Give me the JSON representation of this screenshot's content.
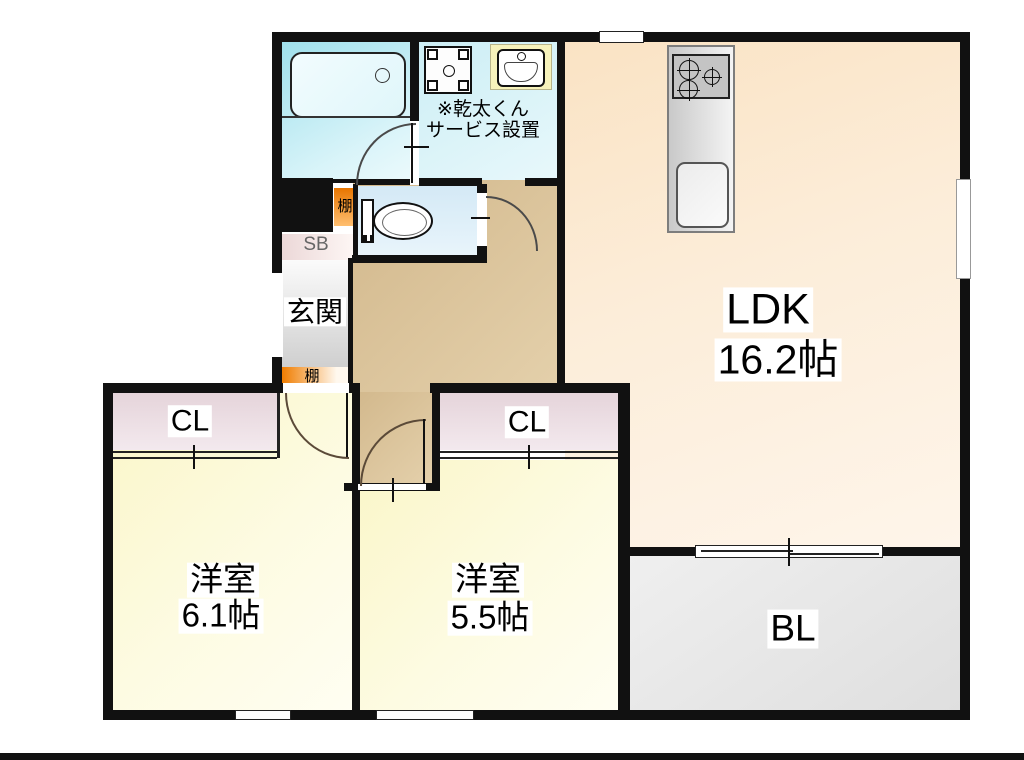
{
  "floorplan": {
    "title": "2LDK apartment floor plan",
    "ldk": {
      "name": "LDK",
      "area": "16.2帖"
    },
    "bedroom1": {
      "name": "洋室",
      "area": "6.1帖"
    },
    "bedroom2": {
      "name": "洋室",
      "area": "5.5帖"
    },
    "closet1": "CL",
    "closet2": "CL",
    "balcony": "BL",
    "entrance": "玄関",
    "shoe_box": "SB",
    "shelf_top": "棚",
    "shelf_bottom": "棚",
    "note": {
      "line1": "※乾太くん",
      "line2": "サービス設置"
    },
    "colors": {
      "wall": "#111111",
      "ldk_floor": "#fae3c4",
      "bedroom_floor": "#faf6c8",
      "bathroom": "#9fe0ec",
      "toilet_room": "#d4e9f6",
      "hallway": "#d2b88c",
      "closet": "#e5d4da",
      "balcony": "#e9e9e9",
      "shelf_orange": "#f07d00",
      "entrance_gray": "#cfcfcf",
      "sink_counter": "#f6f2bb"
    }
  }
}
